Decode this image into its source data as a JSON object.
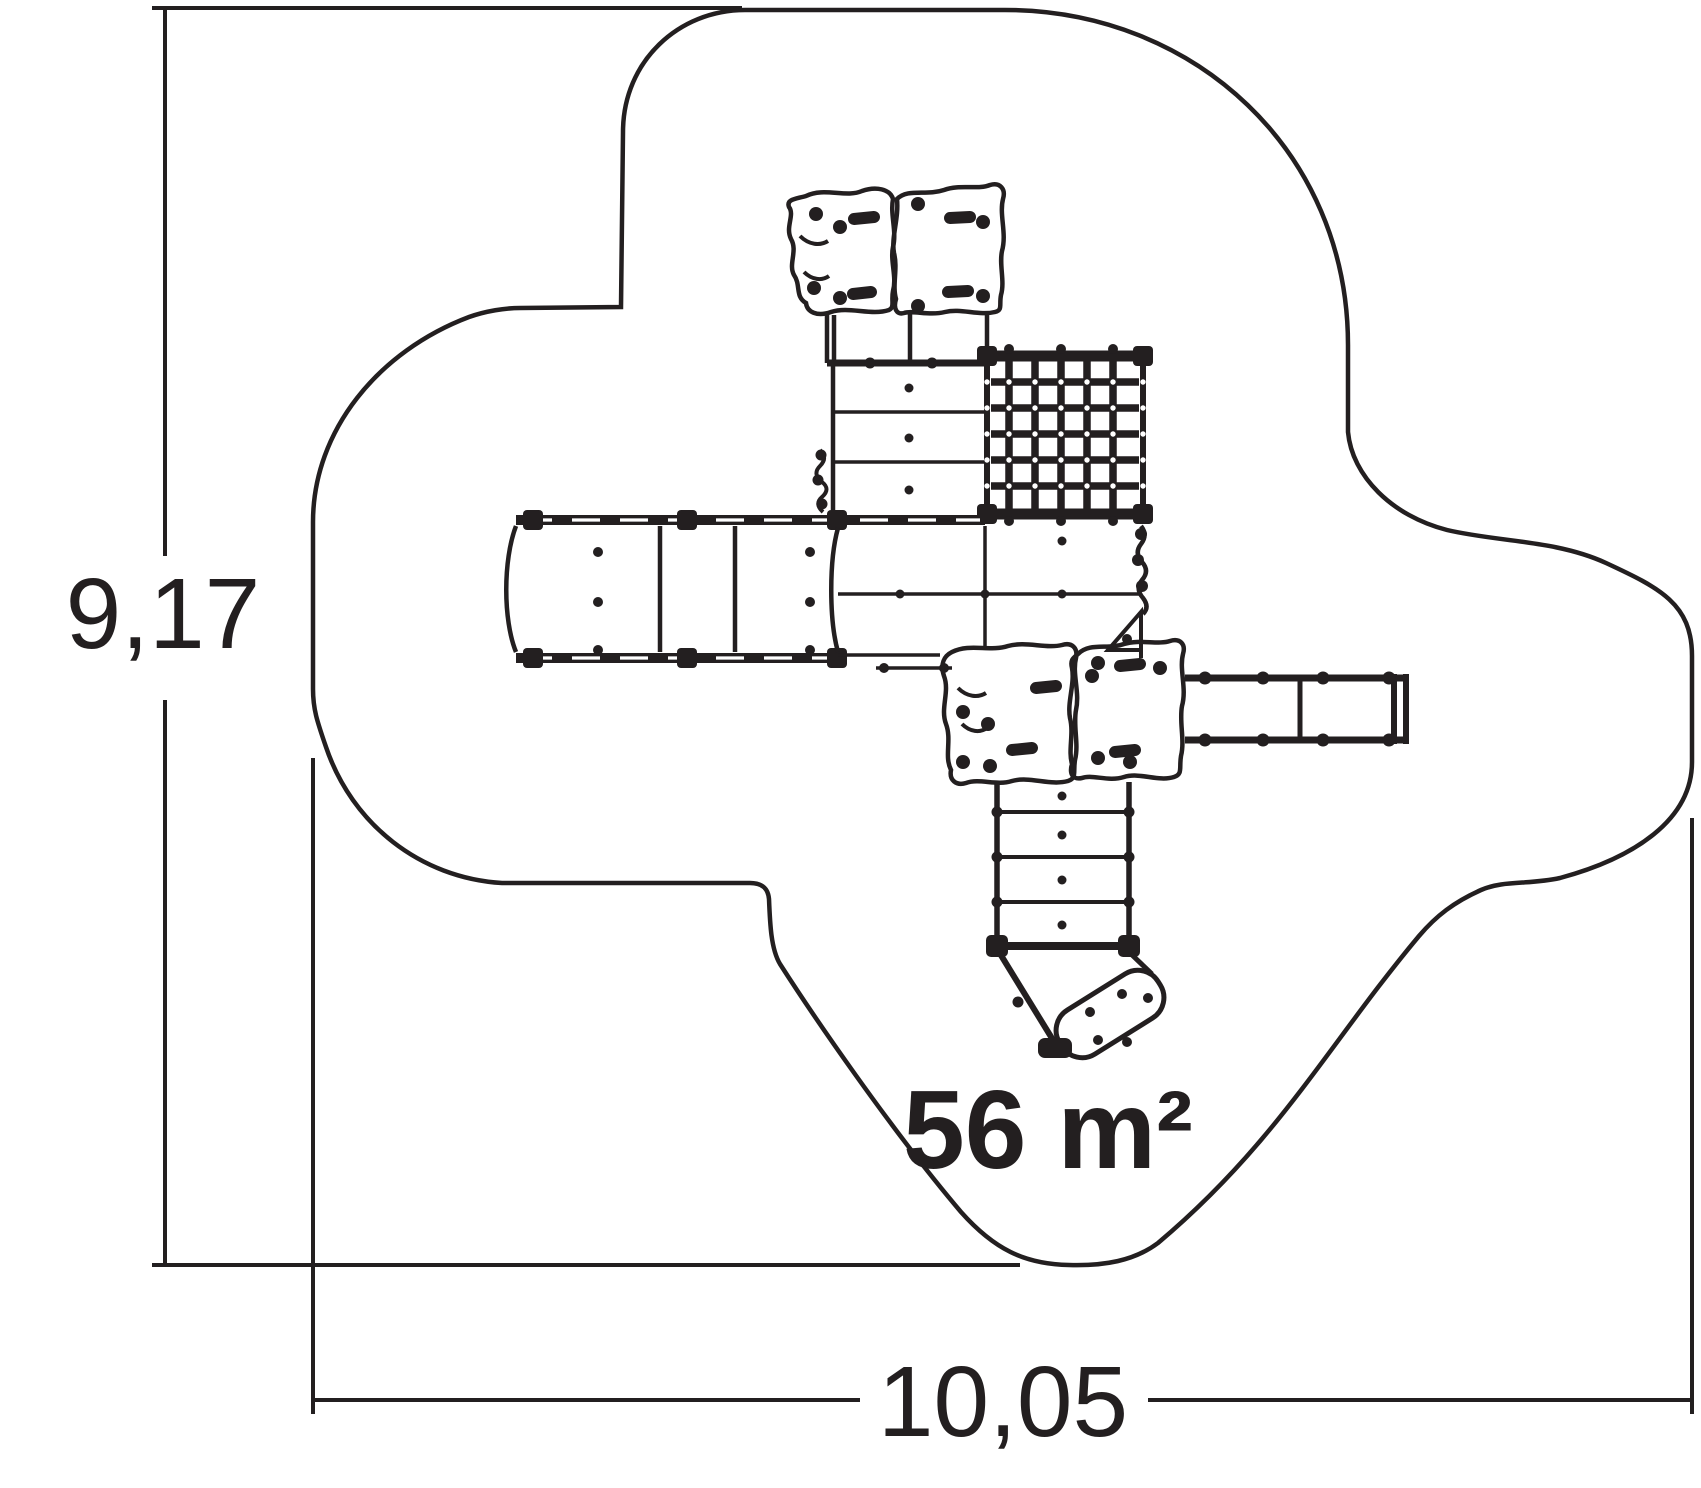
{
  "drawing": {
    "area_label": "56 m²",
    "height_dimension": "9,17",
    "width_dimension": "10,05",
    "line_color": "#231f20",
    "background_color": "#ffffff",
    "parts": [
      "safety-zone-outline",
      "top-play-panels",
      "tower-ladder",
      "climbing-net",
      "bridge-walkway",
      "main-platform",
      "lower-play-panels",
      "horizontal-ladder-arm",
      "staircase",
      "slide-exit",
      "height-dimension",
      "width-dimension"
    ]
  }
}
